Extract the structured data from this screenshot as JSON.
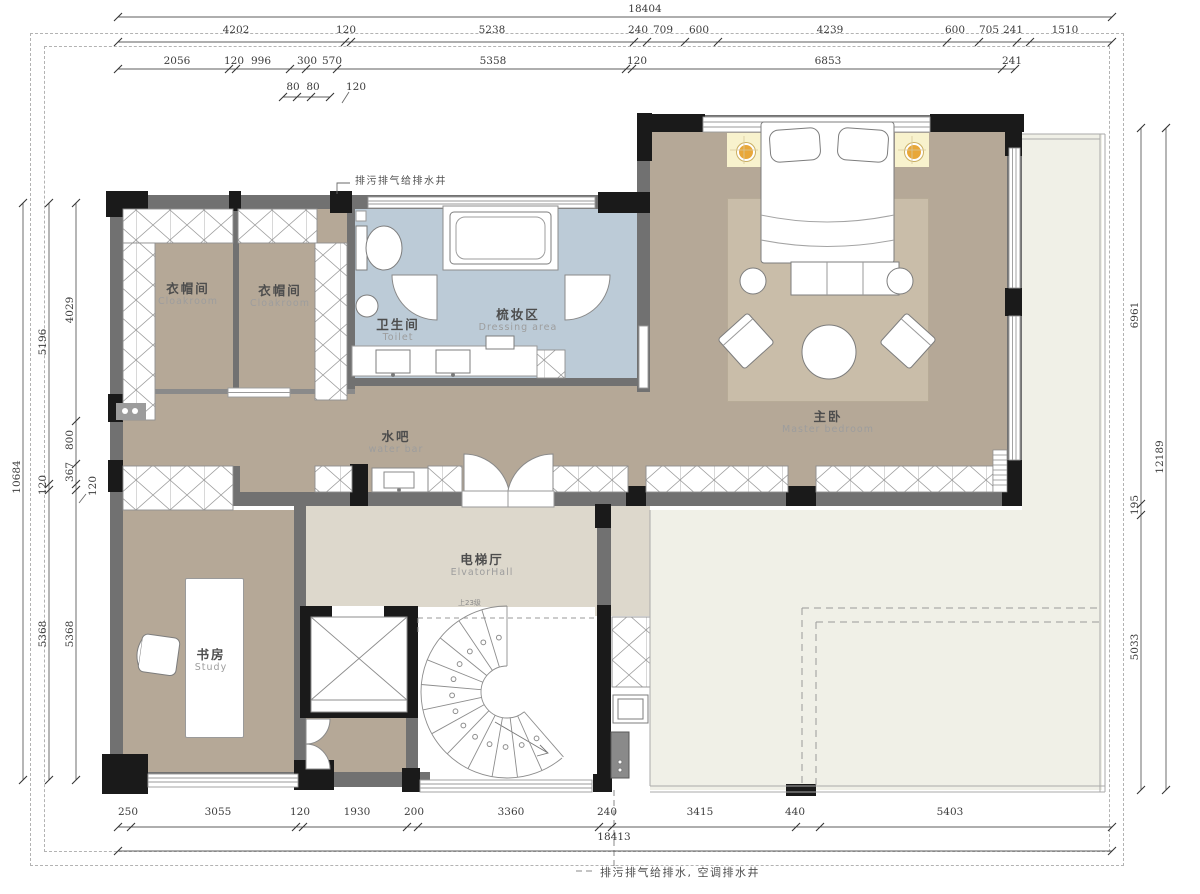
{
  "notes": {
    "top_note": "排污排气给排水井",
    "bottom_note": "排污排气给排水, 空调排水井",
    "stair_note": "上23级"
  },
  "rooms": {
    "cloakroom1": {
      "cn": "衣帽间",
      "en": "Cloakroom"
    },
    "cloakroom2": {
      "cn": "衣帽间",
      "en": "Cloakroom"
    },
    "toilet": {
      "cn": "卫生间",
      "en": "Toilet"
    },
    "dressing": {
      "cn": "梳妆区",
      "en": "Dressing  area"
    },
    "waterbar": {
      "cn": "水吧",
      "en": "water  bar"
    },
    "master_bedroom": {
      "cn": "主卧",
      "en": "Master  bedroom"
    },
    "elevator_hall": {
      "cn": "电梯厅",
      "en": "ElvatorHall"
    },
    "study": {
      "cn": "书房",
      "en": "Study"
    }
  },
  "dimensions": {
    "top_total": "18404",
    "top_row2": [
      "4202",
      "120",
      "5238",
      "240",
      "709",
      "600",
      "4239",
      "600",
      "705",
      "241",
      "1510"
    ],
    "top_row3": [
      "2056",
      "120",
      "996",
      "300",
      "570",
      "5358",
      "120",
      "6853",
      "241"
    ],
    "top_row4": [
      "80",
      "80",
      "120"
    ],
    "left_outer": "10684",
    "left_mid": [
      "5196",
      "120",
      "5368"
    ],
    "left_inner": [
      "4029",
      "800",
      "367",
      "120",
      "5368"
    ],
    "right_inner": [
      "6961",
      "195",
      "5033"
    ],
    "right_outer": "12189",
    "bottom_row1": [
      "250",
      "3055",
      "120",
      "1930",
      "200",
      "3360",
      "240",
      "3415",
      "440",
      "5403"
    ],
    "bottom_total": "18413"
  },
  "colors": {
    "floor_tan": "#b5a897",
    "floor_blue": "#bccbd7",
    "floor_hall": "#ddd8cc",
    "floor_terrace": "#f0f0e7",
    "wall_grey": "#717171",
    "column_black": "#1a1a1a",
    "lamp_pad": "#f8f2cd",
    "lamp_dot": "#e8a73a"
  }
}
